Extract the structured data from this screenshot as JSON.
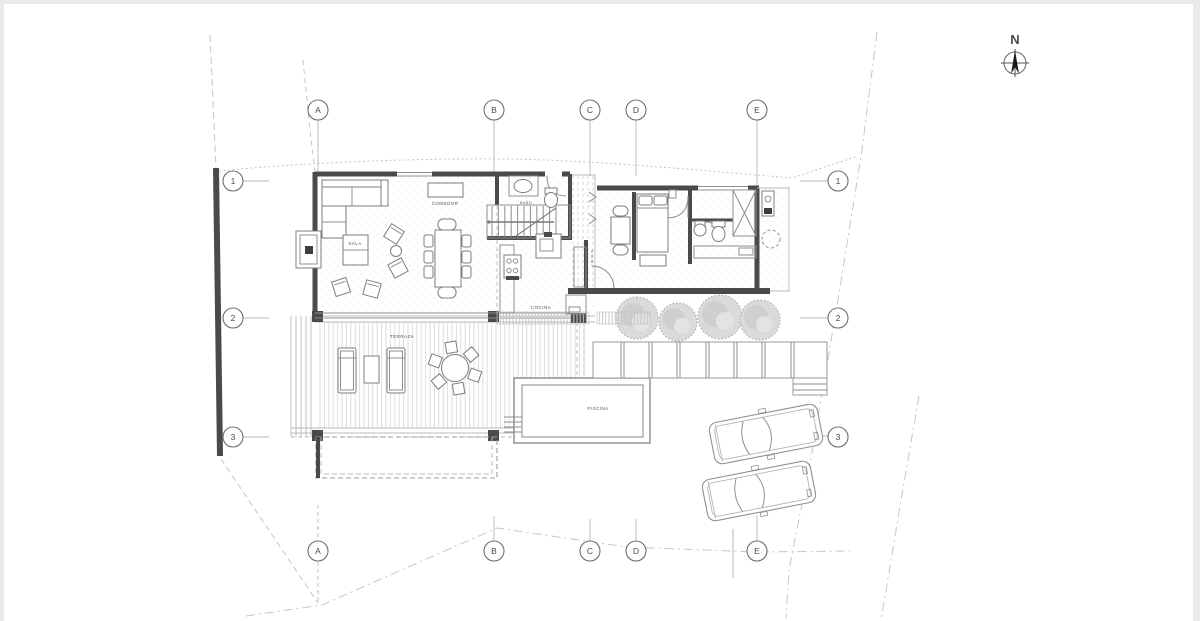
{
  "page": {
    "background": "#ffffff",
    "edge_color": "#e9e9ee"
  },
  "colors": {
    "wall": "#4a4a4a",
    "medium_line": "#8f8f8f",
    "light_line": "#b9b9b9",
    "deck_line": "#dedede",
    "boundary_line": "#c6c6ca",
    "tree_fill": "#d9d9d9",
    "text": "#4a4a4a"
  },
  "north_indicator": {
    "label": "N"
  },
  "grid": {
    "columns": [
      {
        "id": "A"
      },
      {
        "id": "B"
      },
      {
        "id": "C"
      },
      {
        "id": "D"
      },
      {
        "id": "E"
      }
    ],
    "rows": [
      {
        "id": "1"
      },
      {
        "id": "2"
      },
      {
        "id": "3"
      }
    ]
  },
  "rooms": {
    "dining": "COMEDOR",
    "living": "SALA",
    "kitchen": "COCINA",
    "bathroom": "BAÑO",
    "terrace": "TERRAZA",
    "pool": "PISCINA"
  }
}
